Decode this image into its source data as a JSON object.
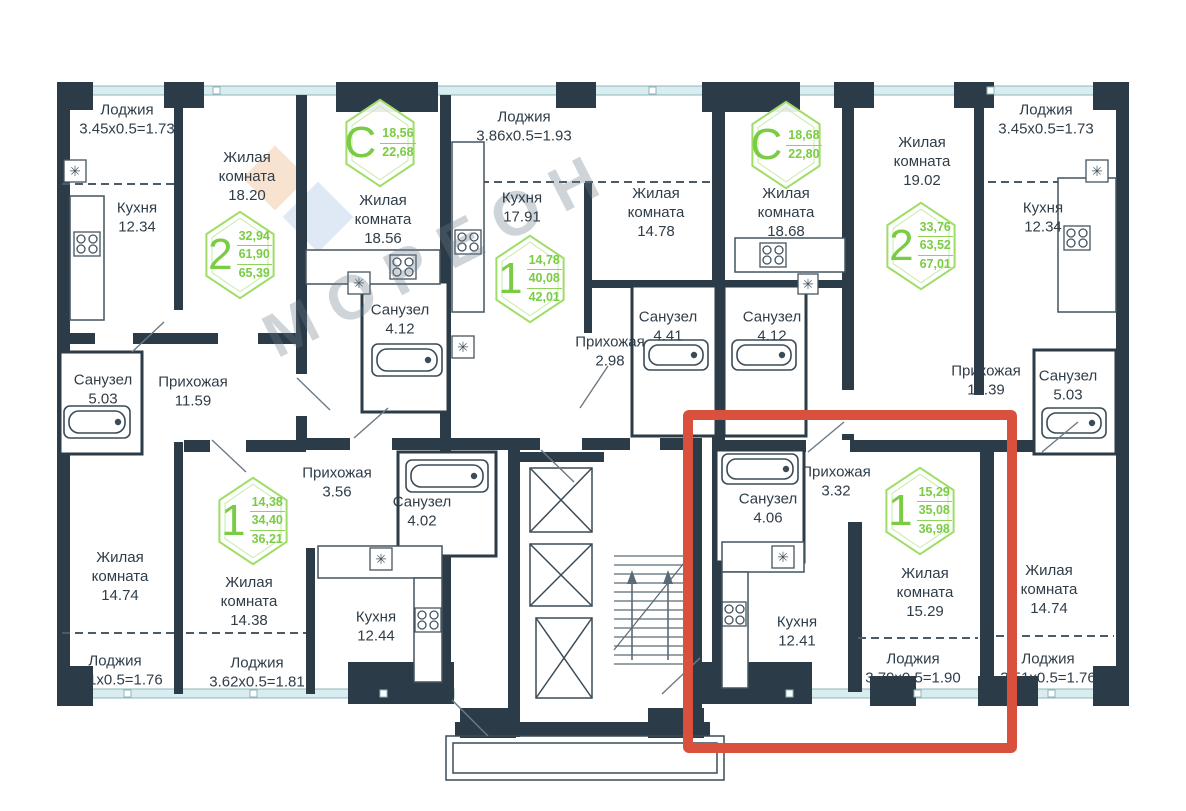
{
  "plan": {
    "watermark": {
      "text": "МОРЕОН"
    },
    "colors": {
      "wall": "#2b3b47",
      "window": "#d9edf0",
      "badge_green": "#79cc43",
      "hex_stroke": "#9edd66",
      "highlight_red": "#d9503c",
      "label_text": "#2f3d49",
      "watermark_orange": "#f8e3d1",
      "watermark_blue": "#dfe9f6"
    },
    "highlight": {
      "x": 683,
      "y": 410,
      "width": 334,
      "height": 343
    },
    "rooms": [
      {
        "name": "Лоджия",
        "value": "3.45x0.5=1.73",
        "x": 127,
        "y": 120,
        "w": 135
      },
      {
        "name": "Жилая комната",
        "value": "18.20",
        "x": 247,
        "y": 177,
        "w": 95
      },
      {
        "name": "Кухня",
        "value": "12.34",
        "x": 137,
        "y": 218,
        "w": 90
      },
      {
        "name": "Жилая комната",
        "value": "18.56",
        "x": 383,
        "y": 220,
        "w": 95
      },
      {
        "name": "Лоджия",
        "value": "3.86x0.5=1.93",
        "x": 524,
        "y": 127,
        "w": 145
      },
      {
        "name": "Кухня",
        "value": "17.91",
        "x": 522,
        "y": 208,
        "w": 90
      },
      {
        "name": "Жилая комната",
        "value": "14.78",
        "x": 656,
        "y": 213,
        "w": 95
      },
      {
        "name": "Жилая комната",
        "value": "18.68",
        "x": 786,
        "y": 213,
        "w": 95
      },
      {
        "name": "Жилая комната",
        "value": "19.02",
        "x": 922,
        "y": 162,
        "w": 95
      },
      {
        "name": "Лоджия",
        "value": "3.45x0.5=1.73",
        "x": 1046,
        "y": 120,
        "w": 135
      },
      {
        "name": "Кухня",
        "value": "12.34",
        "x": 1043,
        "y": 218,
        "w": 90
      },
      {
        "name": "Санузел",
        "value": "4.12",
        "x": 400,
        "y": 320,
        "w": 90
      },
      {
        "name": "Санузел",
        "value": "4.41",
        "x": 668,
        "y": 327,
        "w": 90
      },
      {
        "name": "Санузел",
        "value": "4.12",
        "x": 772,
        "y": 327,
        "w": 90
      },
      {
        "name": "Прихожая",
        "value": "2.98",
        "x": 610,
        "y": 352,
        "w": 100
      },
      {
        "name": "Санузел",
        "value": "5.03",
        "x": 103,
        "y": 390,
        "w": 90
      },
      {
        "name": "Прихожая",
        "value": "11.59",
        "x": 193,
        "y": 392,
        "w": 100
      },
      {
        "name": "Прихожая",
        "value": "12.39",
        "x": 986,
        "y": 381,
        "w": 100
      },
      {
        "name": "Санузел",
        "value": "5.03",
        "x": 1068,
        "y": 386,
        "w": 90
      },
      {
        "name": "Прихожая",
        "value": "3.56",
        "x": 337,
        "y": 483,
        "w": 100
      },
      {
        "name": "Санузел",
        "value": "4.02",
        "x": 422,
        "y": 512,
        "w": 90
      },
      {
        "name": "Жилая комната",
        "value": "14.74",
        "x": 120,
        "y": 577,
        "w": 95
      },
      {
        "name": "Жилая комната",
        "value": "14.38",
        "x": 249,
        "y": 602,
        "w": 95
      },
      {
        "name": "Кухня",
        "value": "12.44",
        "x": 376,
        "y": 627,
        "w": 90
      },
      {
        "name": "Санузел",
        "value": "4.06",
        "x": 768,
        "y": 509,
        "w": 90
      },
      {
        "name": "Прихожая",
        "value": "3.32",
        "x": 836,
        "y": 482,
        "w": 100
      },
      {
        "name": "Кухня",
        "value": "12.41",
        "x": 797,
        "y": 632,
        "w": 90
      },
      {
        "name": "Жилая комната",
        "value": "15.29",
        "x": 925,
        "y": 593,
        "w": 95
      },
      {
        "name": "Жилая комната",
        "value": "14.74",
        "x": 1049,
        "y": 590,
        "w": 95
      },
      {
        "name": "Лоджия",
        "value": "3.51x0.5=1.76",
        "x": 115,
        "y": 671,
        "w": 135
      },
      {
        "name": "Лоджия",
        "value": "3.62x0.5=1.81",
        "x": 257,
        "y": 673,
        "w": 140
      },
      {
        "name": "Лоджия",
        "value": "3.79x0.5=1.90",
        "x": 913,
        "y": 669,
        "w": 145
      },
      {
        "name": "Лоджия",
        "value": "3.51x0.5=1.76",
        "x": 1048,
        "y": 669,
        "w": 135
      }
    ],
    "badges": [
      {
        "type": "2",
        "values": [
          "32,94",
          "61,90",
          "65,39"
        ],
        "x": 240,
        "y": 255
      },
      {
        "type": "C",
        "values": [
          "18,56",
          "22,68"
        ],
        "x": 380,
        "y": 143
      },
      {
        "type": "1",
        "values": [
          "14,78",
          "40,08",
          "42,01"
        ],
        "x": 530,
        "y": 279
      },
      {
        "type": "C",
        "values": [
          "18,68",
          "22,80"
        ],
        "x": 786,
        "y": 145
      },
      {
        "type": "2",
        "values": [
          "33,76",
          "63,52",
          "67,01"
        ],
        "x": 921,
        "y": 246
      },
      {
        "type": "1",
        "values": [
          "14,38",
          "34,40",
          "36,21"
        ],
        "x": 253,
        "y": 521
      },
      {
        "type": "1",
        "values": [
          "15,29",
          "35,08",
          "36,98"
        ],
        "x": 920,
        "y": 511
      }
    ]
  }
}
